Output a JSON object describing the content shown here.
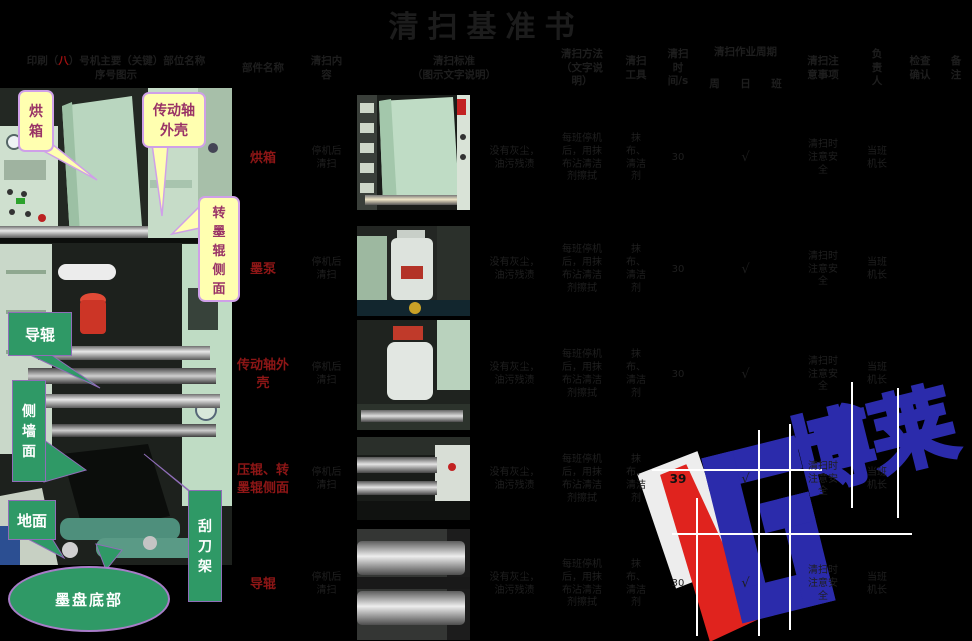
{
  "title": "清扫基准书",
  "header": {
    "map_pre": "印刷（",
    "map_num": "八",
    "map_post": "）号机主要（关键）部位名称",
    "map_line2": "序号图示",
    "part": "部件名称",
    "content": "清扫内容",
    "standard_l1": "清扫标准",
    "standard_l2": "（图示文字说明）",
    "method": "清扫方法（文字说明）",
    "tool": "清扫工具",
    "time": "清扫时间/s",
    "cycle": "清扫作业周期",
    "cycle_week": "周",
    "cycle_day": "日",
    "cycle_shift": "班",
    "notes": "清扫注意事项",
    "owner": "负责人",
    "check": "检查确认",
    "remark": "备注"
  },
  "rows": [
    {
      "name": "烘箱",
      "content": "停机后清扫",
      "standard": "没有灰尘，油污残渍",
      "method": "每班停机后，用抹布沾清洁剂擦拭",
      "tool": "抹布、清洁剂",
      "time": "30",
      "week": "",
      "day": "√",
      "shift": "",
      "notes": "清扫时注意安全",
      "owner": "当班机长",
      "check": "",
      "remark": ""
    },
    {
      "name": "墨泵",
      "content": "停机后清扫",
      "standard": "没有灰尘，油污残渍",
      "method": "每班停机后，用抹布沾清洁剂擦拭",
      "tool": "抹布、清洁剂",
      "time": "30",
      "week": "",
      "day": "√",
      "shift": "",
      "notes": "清扫时注意安全",
      "owner": "当班机长",
      "check": "",
      "remark": ""
    },
    {
      "name": "传动轴外壳",
      "content": "停机后清扫",
      "standard": "没有灰尘，油污残渍",
      "method": "每班停机后，用抹布沾清洁剂擦拭",
      "tool": "抹布、清洁剂",
      "time": "30",
      "week": "",
      "day": "√",
      "shift": "",
      "notes": "清扫时注意安全",
      "owner": "当班机长",
      "check": "",
      "remark": ""
    },
    {
      "name": "压辊、转墨辊侧面",
      "content": "停机后清扫",
      "standard": "没有灰尘，油污残渍",
      "method": "每班停机后，用抹布沾清洁剂擦拭",
      "tool": "抹布、清洁剂",
      "time": "39",
      "week": "",
      "day": "√",
      "shift": "",
      "notes": "清扫时注意安全",
      "owner": "当班机长",
      "check": "",
      "remark": ""
    },
    {
      "name": "导辊",
      "content": "停机后清扫",
      "standard": "没有灰尘，油污残渍",
      "method": "每班停机后，用抹布沾清洁剂擦拭",
      "tool": "抹布、清洁剂",
      "time": "30",
      "week": "",
      "day": "√",
      "shift": "",
      "notes": "清扫时注意安全",
      "owner": "当班机长",
      "check": "",
      "remark": ""
    }
  ],
  "callouts": {
    "yellow": [
      {
        "label": "烘箱"
      },
      {
        "label": "传动轴外壳"
      },
      {
        "label": "转墨辊侧面"
      }
    ],
    "green": [
      {
        "label": "导辊"
      },
      {
        "label": "侧墙面"
      },
      {
        "label": "地面"
      },
      {
        "label": "刮刀架"
      },
      {
        "label": "墨盘底部"
      }
    ]
  },
  "watermark": {
    "chars": "博莱"
  },
  "colors": {
    "faint_text": "#1f1f1f",
    "part_name_red": "#8d1616",
    "callout_yellow": "#ffffb0",
    "callout_green": "#2f9966",
    "callout_purple_text": "#993366",
    "watermark_blue": "#2b2bab",
    "watermark_red": "#e0231e"
  }
}
